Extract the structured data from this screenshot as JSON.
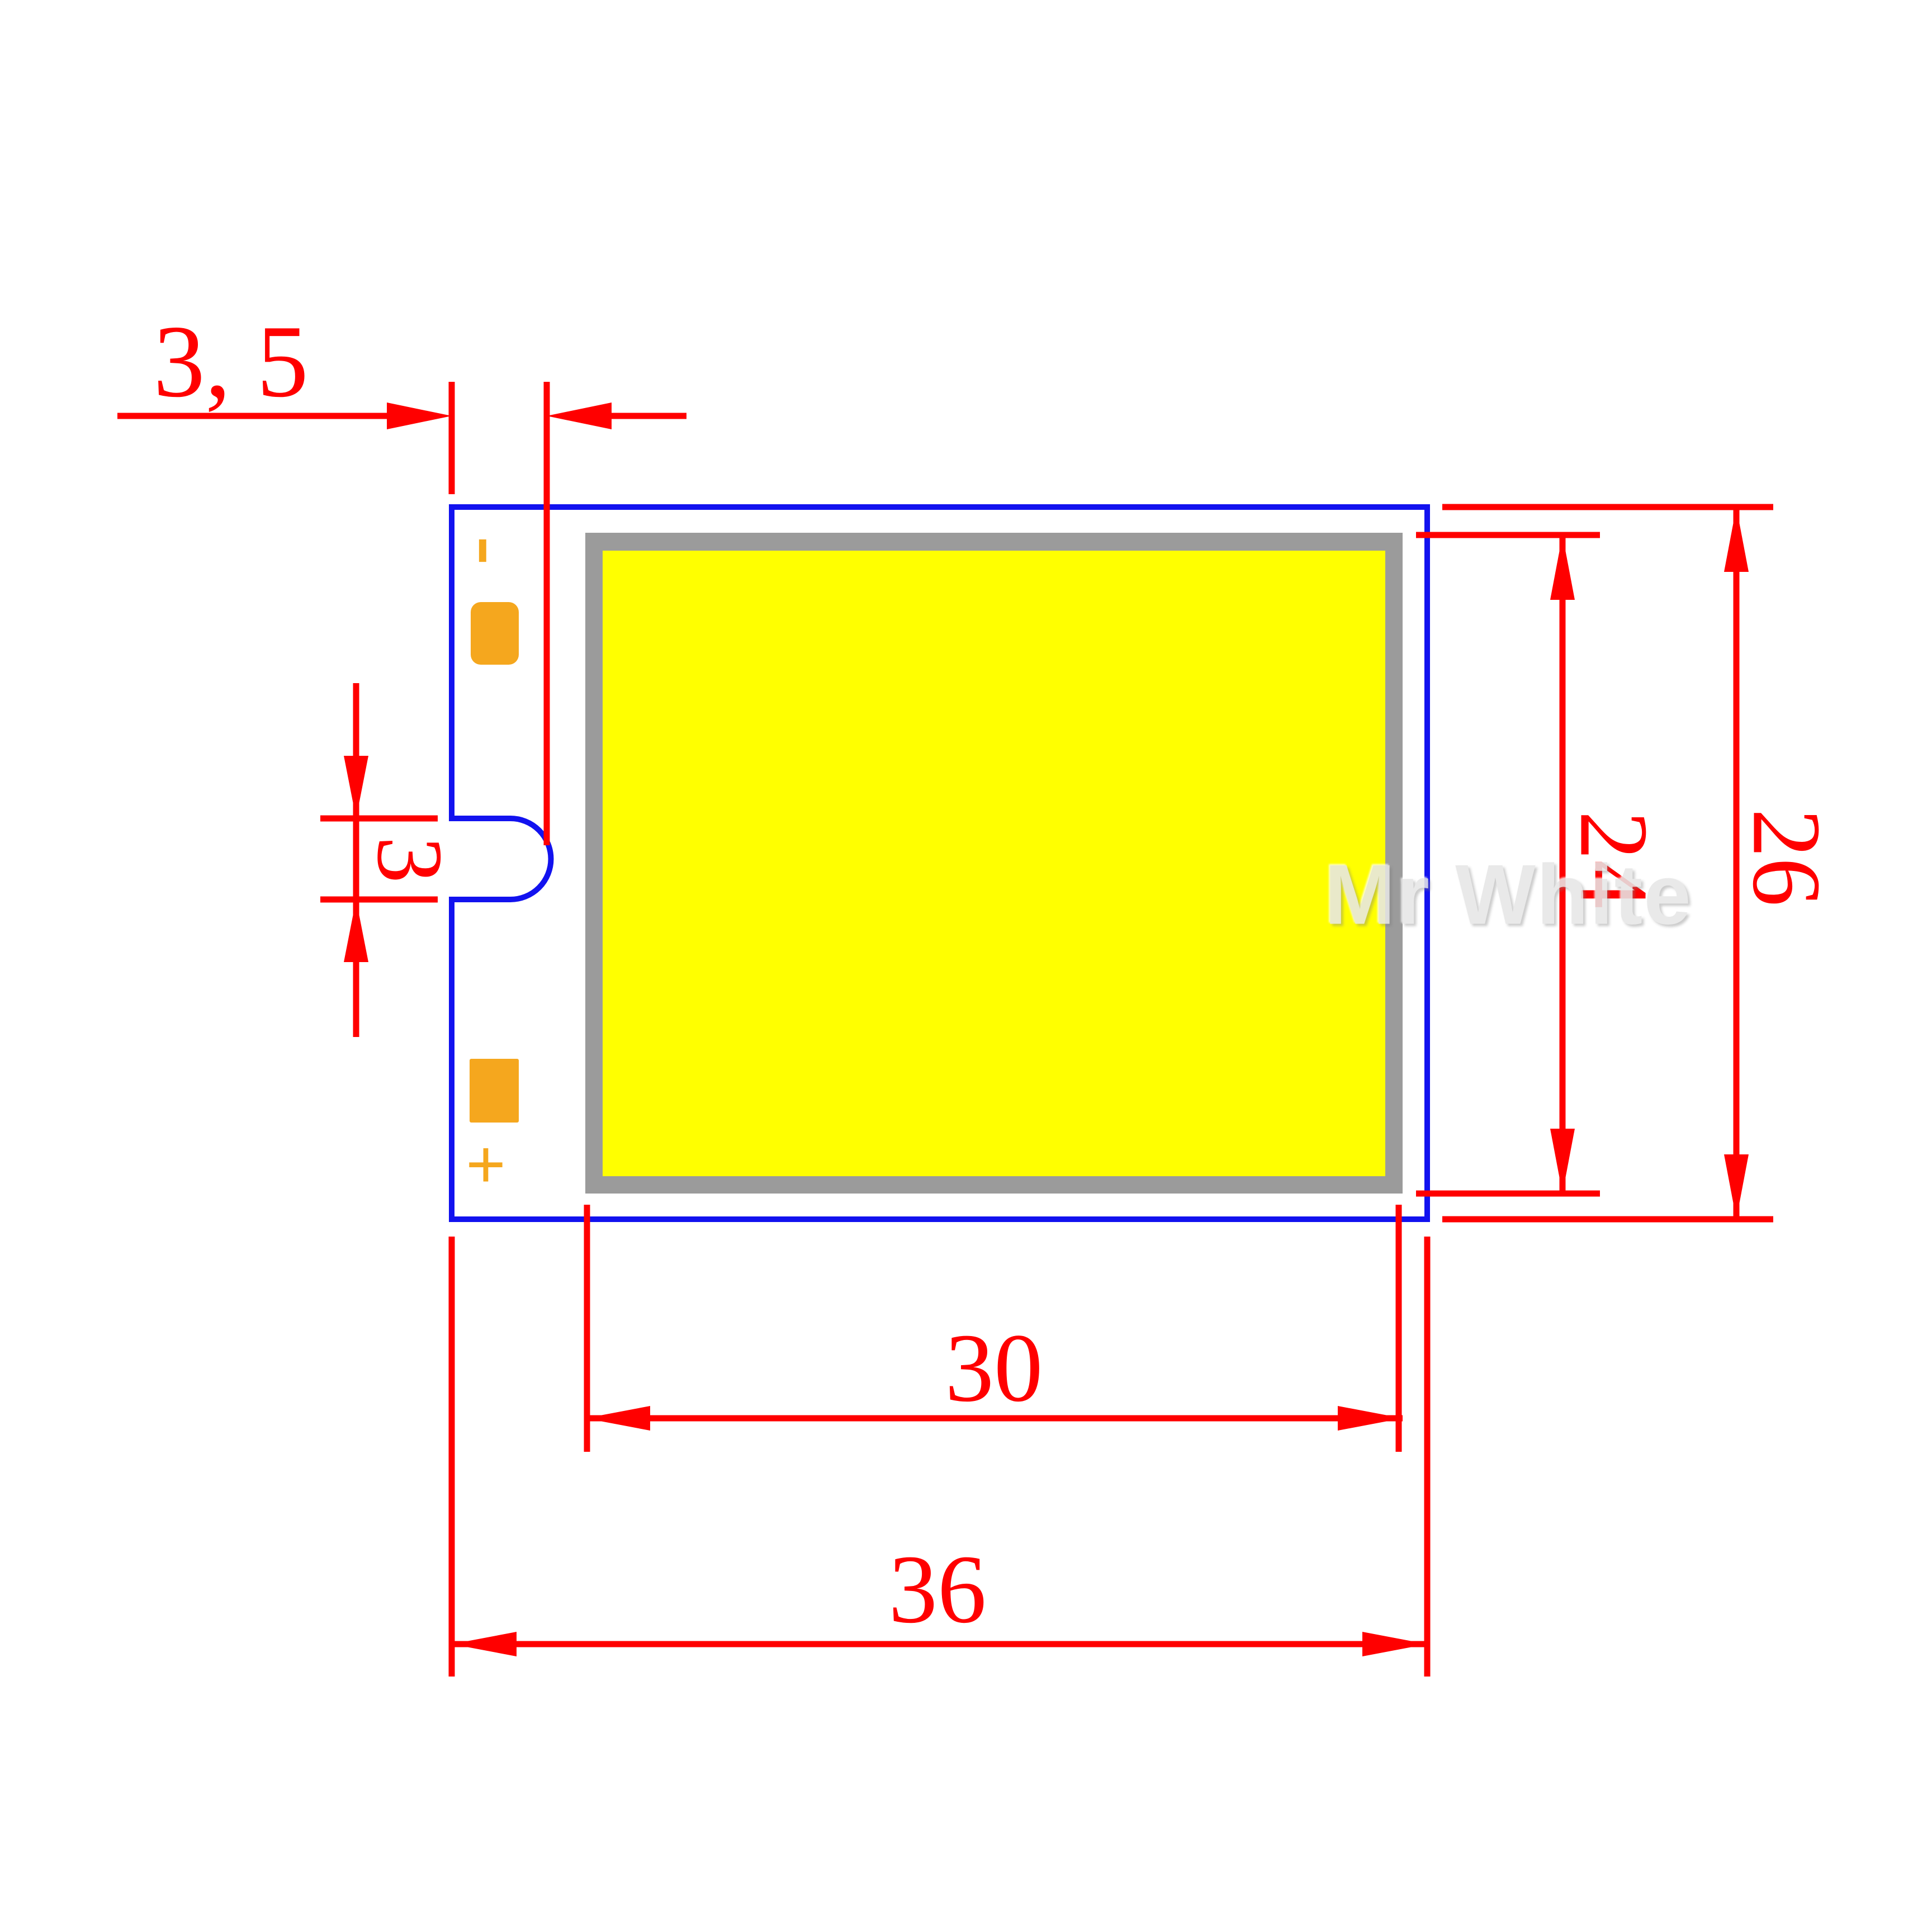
{
  "drawing": {
    "watermark": "Mr White",
    "labels": {
      "pad_offset": "3, 5",
      "notch_height": "3",
      "emitter_height": "24",
      "board_height": "26",
      "emitter_width": "30",
      "board_width": "36"
    },
    "polarity": {
      "negative": "-",
      "positive": "+"
    },
    "colors": {
      "dimension_red": "#FF0000",
      "outline_blue": "#1212EF",
      "emitter_yellow": "#FFFF00",
      "frame_gray": "#9B9B9B",
      "pad_orange": "#F5A71E",
      "watermark_gray": "#E6E6E6"
    }
  }
}
